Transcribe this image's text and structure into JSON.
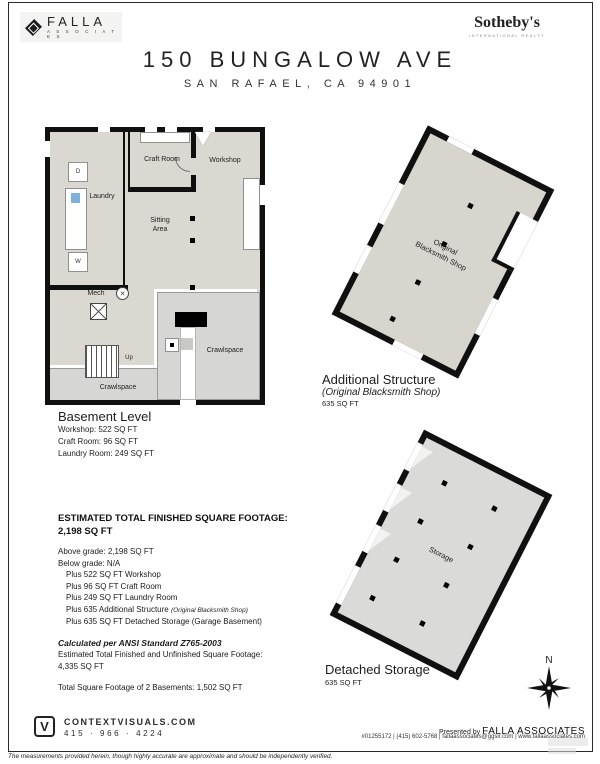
{
  "header": {
    "falla_name": "FALLA",
    "falla_sub": "A S S O C I A T E S",
    "sothebys_name": "Sotheby's",
    "sothebys_sub": "INTERNATIONAL REALTY",
    "title": "150 BUNGALOW AVE",
    "subtitle": "SAN RAFAEL, CA 94901"
  },
  "basement": {
    "rooms": {
      "laundry": "Laundry",
      "craft": "Craft Room",
      "workshop": "Workshop",
      "sitting_line1": "Sitting",
      "sitting_line2": "Area",
      "mech": "Mech",
      "up": "Up",
      "crawlspace": "Crawlspace",
      "dryer": "D",
      "washer": "W",
      "mech_symbol": "✕"
    },
    "caption_title": "Basement Level",
    "caption_lines": [
      "Workshop: 522 SQ FT",
      "Craft Room: 96 SQ FT",
      "Laundry Room: 249 SQ FT"
    ]
  },
  "additional_structure": {
    "room_line1": "Original",
    "room_line2": "Blacksmith Shop",
    "caption_title": "Additional Structure",
    "caption_sub": "(Original Blacksmith Shop)",
    "caption_area": "635 SQ FT"
  },
  "detached_storage": {
    "room_label": "Storage",
    "caption_title": "Detached Storage",
    "caption_area": "635 SQ FT"
  },
  "summary": {
    "heading_line1": "ESTIMATED TOTAL FINISHED SQUARE FOOTAGE:",
    "heading_line2": "2,198 SQ FT",
    "lines": [
      {
        "text": "Above grade: 2,198 SQ FT"
      },
      {
        "text": "Below grade: N/A"
      },
      {
        "text": "Plus 522 SQ FT Workshop"
      },
      {
        "text": "Plus 96 SQ FT Craft Room"
      },
      {
        "text": "Plus 249 SQ FT Laundry Room"
      },
      {
        "text": "Plus 635 Additional Structure ",
        "note": "(Original Blacksmith Shop)"
      },
      {
        "text": "Plus 635 SQ FT Detached Storage (Garage Basement)"
      }
    ],
    "ansi_note": "Calculated per ANSI Standard Z765-2003",
    "total_line1": "Estimated Total Finished and Unfinished Square Footage:",
    "total_line2": "4,335 SQ FT",
    "basements_total": "Total Square Footage of 2 Basements: 1,502 SQ FT"
  },
  "compass": {
    "label": "N"
  },
  "footer": {
    "logo_letter": "V",
    "site": "CONTEXTVISUALS.COM",
    "phone": "415 · 966 · 4224",
    "presented_prefix": "Presented by ",
    "presented_name": "FALLA ASSOCIATES",
    "contact_line": "#01255172 | (415) 602-5768 | fallaassociates@ggsir.com | www.fallaassociates.com",
    "disclaimer": "The measurements provided herein, though highly accurate are approximate and should be independently verified."
  }
}
